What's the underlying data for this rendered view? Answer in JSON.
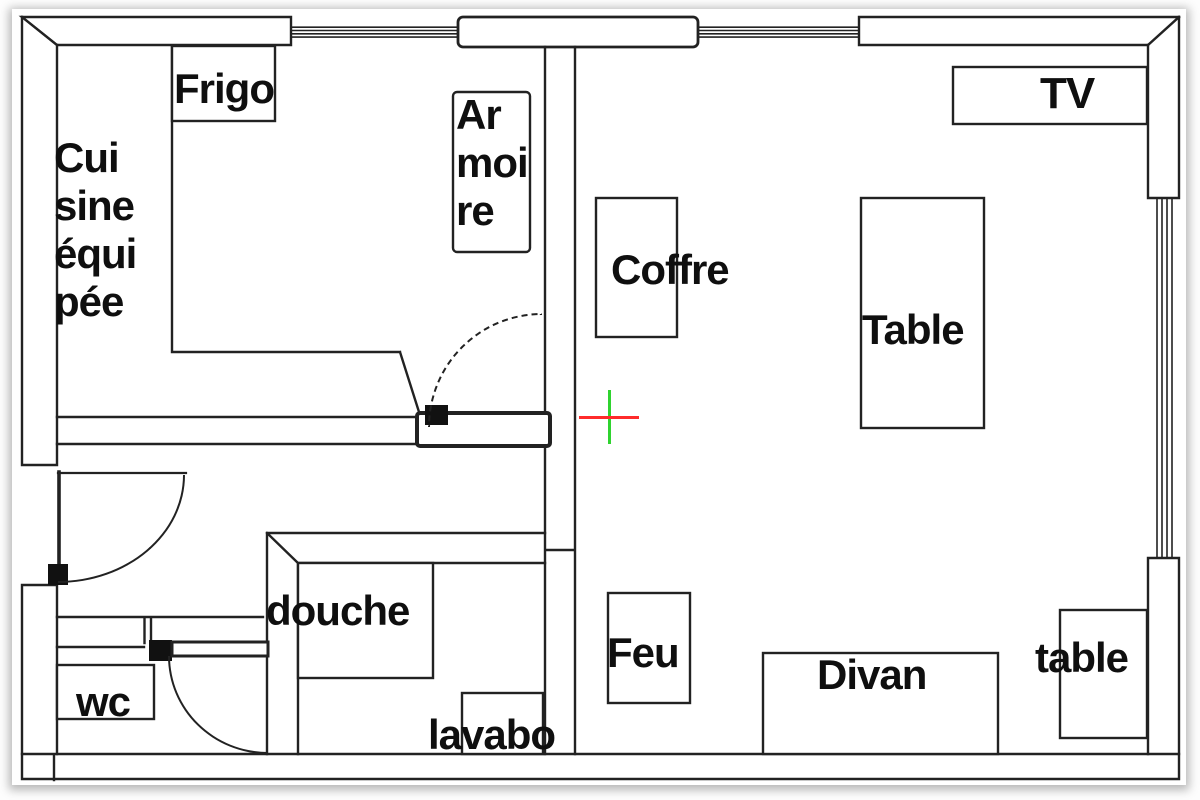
{
  "plan": {
    "title": "apartment-floor-plan",
    "labels": {
      "frigo": "Frigo",
      "cuisine_lines": [
        "Cui",
        "sine",
        "équi",
        "pée"
      ],
      "armoire_lines": [
        "Ar",
        "moi",
        "re"
      ],
      "coffre": "Coffre",
      "tv": "TV",
      "table": "Table",
      "feu": "Feu",
      "divan": "Divan",
      "small_table": "table",
      "douche": "douche",
      "lavabo": "lavabo",
      "wc": "wc"
    },
    "colors": {
      "ink": "#222222",
      "paper": "#ffffff",
      "crosshair_red": "#ff2b2b",
      "crosshair_green": "#2fd32f"
    },
    "crosshair": {
      "x": 609,
      "y": 417,
      "arm_h": 30,
      "arm_v": 27
    }
  }
}
